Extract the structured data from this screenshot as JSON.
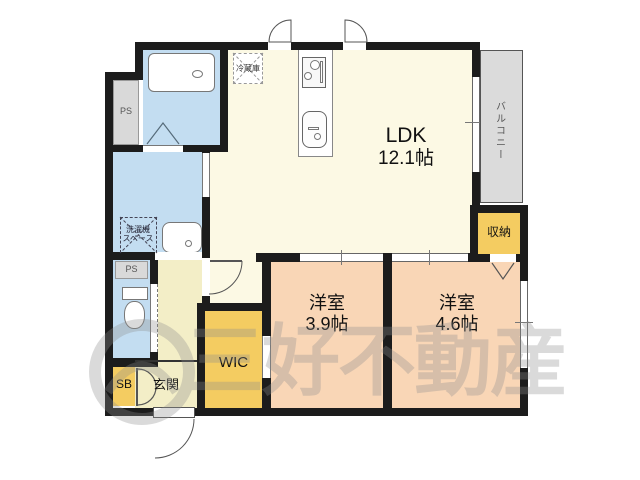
{
  "title": "floor-plan",
  "rooms": {
    "ldk": {
      "name": "LDK",
      "size": "12.1帖"
    },
    "bedroom_39": {
      "name": "洋室",
      "size": "3.9帖"
    },
    "bedroom_46": {
      "name": "洋室",
      "size": "4.6帖"
    },
    "balcony": {
      "name": "バルコニー"
    },
    "storage": {
      "name": "収納"
    },
    "wic": {
      "name": "WIC"
    },
    "genkan": {
      "name": "玄関"
    },
    "shoebox": {
      "name": "SB"
    },
    "ps_top": {
      "name": "PS"
    },
    "ps_bottom": {
      "name": "PS"
    },
    "fridge": {
      "name": "冷蔵庫"
    },
    "laundry": {
      "line1": "洗濯機",
      "line2": "スペース"
    }
  },
  "watermark": {
    "text": "三好不動産"
  },
  "colors": {
    "wall": "#1c1c1c",
    "ldk": "#fcf9e4",
    "hall": "#f3eec7",
    "wet": "#c3ddf1",
    "closet": "#f4cc61",
    "bedroom": "#f9d6b6",
    "balcony": "#dbdbdb",
    "ps": "#d9d9d9",
    "label": "#111111",
    "muted": "#555555",
    "watermark": "#8e8e8e"
  }
}
